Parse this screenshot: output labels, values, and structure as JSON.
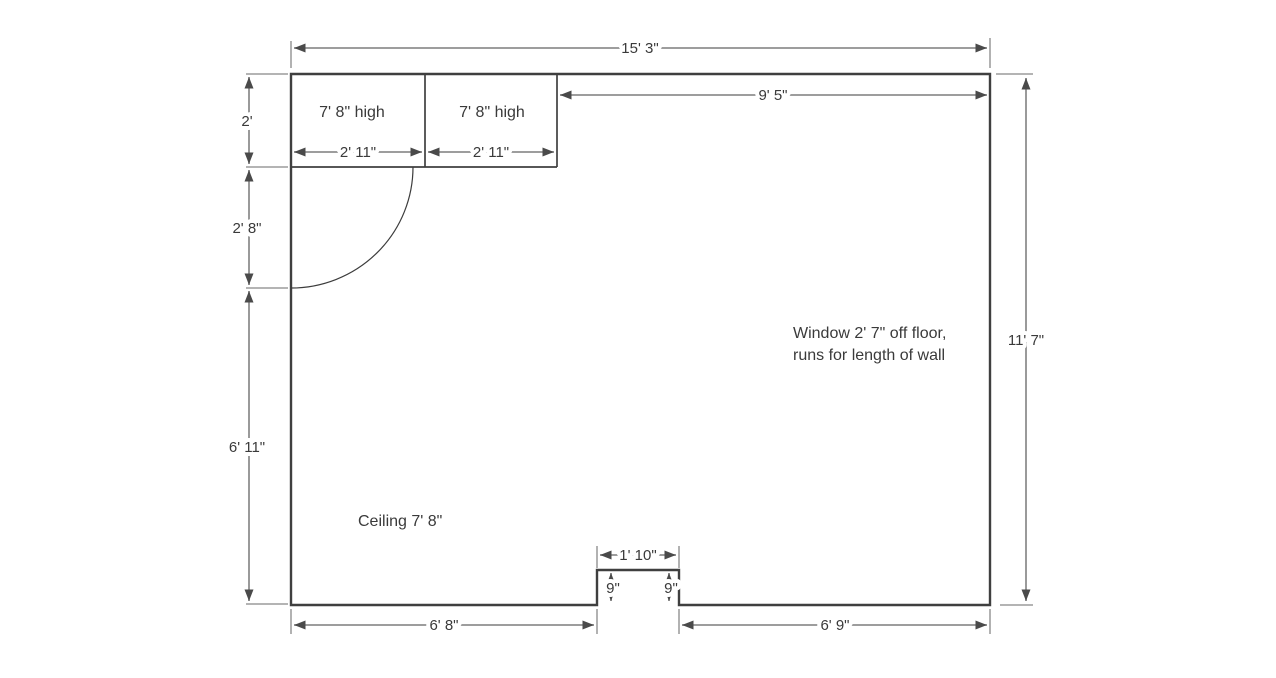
{
  "drawing": {
    "room": {
      "width_label": "15' 3\"",
      "height_label": "11' 7\"",
      "ceiling_note": "Ceiling 7' 8\"",
      "window_note_line1": "Window 2' 7\" off floor,",
      "window_note_line2": "runs for length of wall"
    },
    "closets": {
      "left": {
        "height_note": "7' 8\" high",
        "width_label": "2' 11\""
      },
      "right": {
        "height_note": "7' 8\" high",
        "width_label": "2' 11\""
      }
    },
    "top_wall": {
      "right_segment_label": "9' 5\""
    },
    "left_wall": {
      "top_segment_label": "2'",
      "door_segment_label": "2' 8\"",
      "bottom_segment_label": "6' 11\""
    },
    "bottom_wall": {
      "left_segment_label": "6' 8\"",
      "right_segment_label": "6' 9\"",
      "notch_width_label": "1' 10\"",
      "notch_depth_left_label": "9\"",
      "notch_depth_right_label": "9\""
    },
    "colors": {
      "wall": "#3f3f3f",
      "dimension_line": "#8f8f8f",
      "extension_line": "#a9a9a9",
      "arrowhead": "#4a4a4a",
      "text": "#3a3a3a",
      "background": "#ffffff"
    }
  }
}
